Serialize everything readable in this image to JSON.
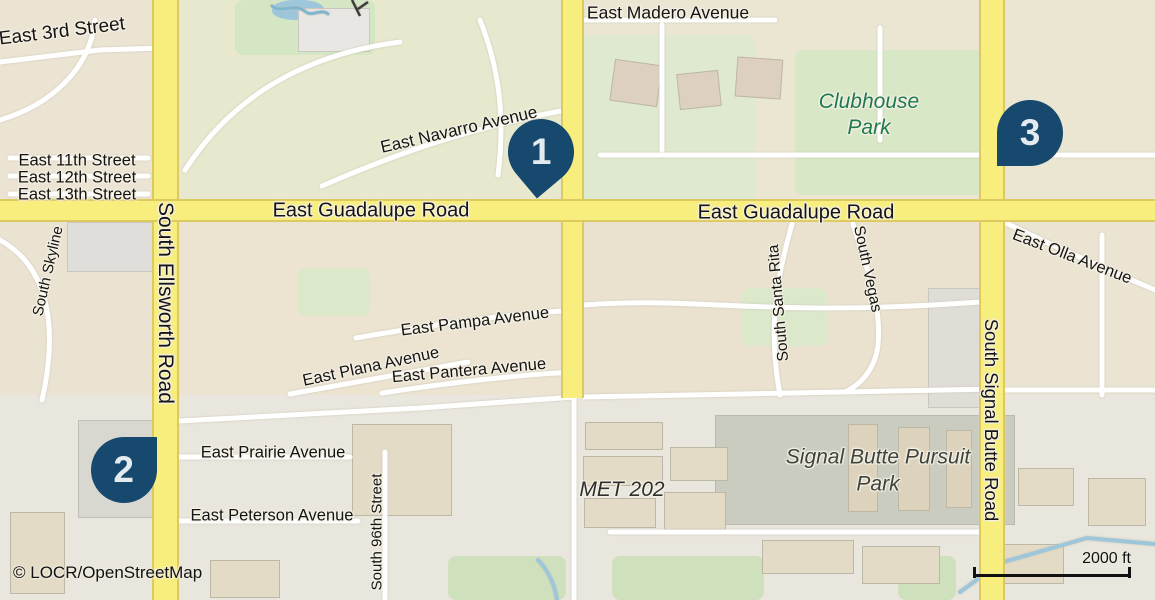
{
  "labels": {
    "east_3rd_street": "East 3rd Street",
    "east_11th_street": "East 11th Street",
    "east_12th_street": "East 12th Street",
    "east_13th_street": "East 13th Street",
    "south_ellsworth_road": "South Ellsworth Road",
    "east_navarro_avenue": "East Navarro Avenue",
    "east_guadalupe_road_west": "East Guadalupe Road",
    "east_guadalupe_road_east": "East Guadalupe Road",
    "east_madero_avenue": "East Madero Avenue",
    "clubhouse_park": "Clubhouse Park",
    "south_signal_butte_road": "South Signal Butte Road",
    "east_olla_avenue": "East Olla Avenue",
    "south_skyline": "South Skyline",
    "east_pampa_avenue": "East Pampa Avenue",
    "east_plana_avenue": "East Plana Avenue",
    "east_pantera_avenue": "East Pantera Avenue",
    "south_santa_rita": "South Santa Rita",
    "south_vegas": "South Vegas",
    "met_202": "MET 202",
    "signal_butte_pursuit_park": "Signal Butte Pursuit Park",
    "east_prairie_avenue": "East Prairie Avenue",
    "east_peterson_avenue": "East Peterson Avenue",
    "south_96th_street": "South 96th Street"
  },
  "markers": [
    {
      "number": "1"
    },
    {
      "number": "2"
    },
    {
      "number": "3"
    }
  ],
  "scale_bar": {
    "label": "2000 ft"
  },
  "attribution": "© LOCR/OpenStreetMap",
  "colors": {
    "marker_blue": "#17486d",
    "road_yellow": "#f8ee7d",
    "park_green": "#d8e7c5",
    "water_blue": "#9dc6db",
    "label_green": "#1d7a50"
  }
}
